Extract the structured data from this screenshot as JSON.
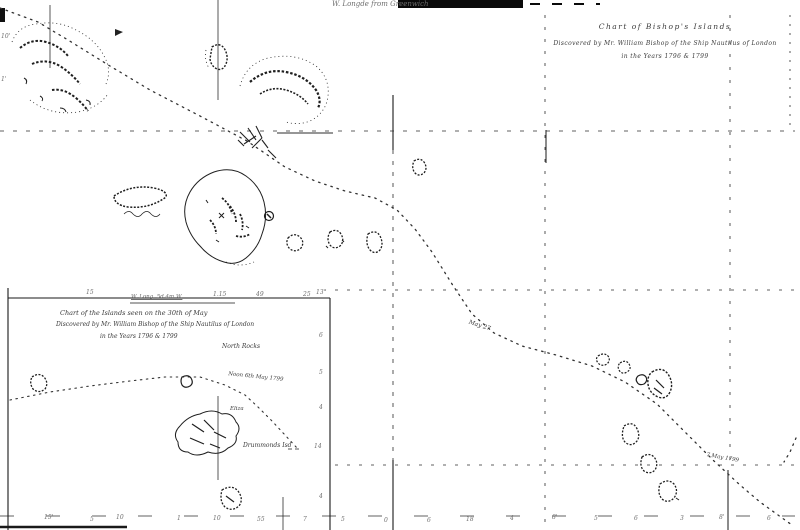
{
  "title": {
    "line1": "Chart of Bishop's Islands",
    "line2": "Discovered by Mr. William Bishop of the Ship Nautilus of London",
    "line3": "in the Years 1796 & 1799"
  },
  "top_label": "W. Longde from Greenwich",
  "inset": {
    "title1": "Chart of the Islands seen on the 30th of May",
    "title2": "Discovered by Mr. William Bishop of the Ship Nautilus of London",
    "title3": "in the Years 1796 & 1799",
    "border_label": "W. Long. 5d 4m W.",
    "north_rocks": "North Rocks",
    "noon_label": "Noon 6th May 1799",
    "island_label": "Drummonds Isd",
    "eliza_label": "Eliza",
    "top_ticks": [
      "15",
      "1.15",
      "49",
      "25"
    ],
    "right_ticks": [
      "13°",
      "6",
      "5",
      "4",
      "14",
      "4"
    ]
  },
  "track": {
    "date1": "May 27",
    "date2": "7 May 1799"
  },
  "edge_labels": {
    "left": [
      "10'",
      "1'"
    ],
    "bottom": [
      "15'",
      "5",
      "10",
      "1",
      "10",
      "55",
      "7",
      "5",
      "0",
      "6",
      "18",
      "4",
      "8'",
      "5",
      "6",
      "3",
      "8'",
      "6"
    ]
  },
  "colors": {
    "ink": "#1f1f1f",
    "faint": "#6e6e6e",
    "paper": "#ffffff"
  }
}
